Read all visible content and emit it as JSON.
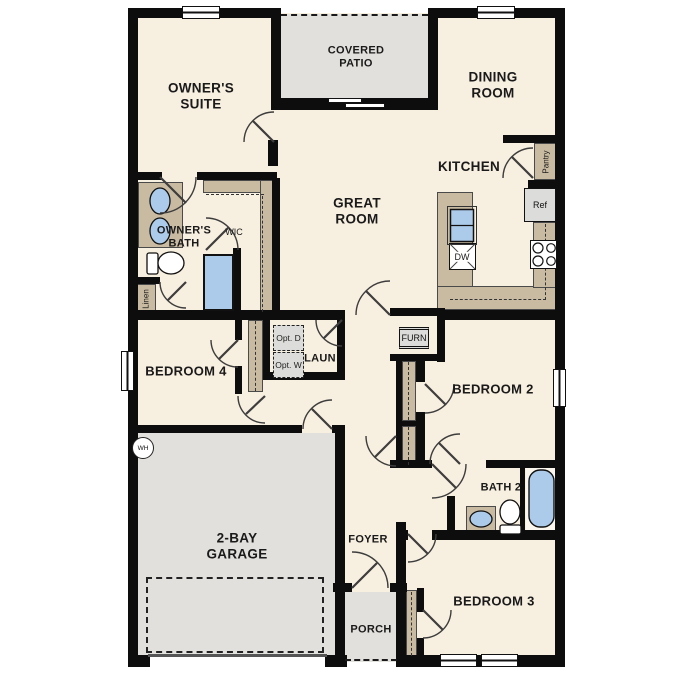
{
  "plan_title": "single-story floor plan",
  "colors": {
    "floor": "#f7efdf",
    "wall": "#0d0d0d",
    "cabinet": "#c9bba2",
    "concrete": "#e2e0dc",
    "fixture_blue": "#accbea"
  },
  "rooms": {
    "owners_suite": "OWNER'S SUITE",
    "covered_patio": "COVERED PATIO",
    "dining_room": "DINING ROOM",
    "kitchen": "KITCHEN",
    "great_room": "GREAT ROOM",
    "owners_bath": "OWNER'S BATH",
    "wic": "WIC",
    "laundry": "LAUN",
    "bedroom_2": "BEDROOM 2",
    "bedroom_3": "BEDROOM 3",
    "bedroom_4": "BEDROOM 4",
    "bath_2": "BATH 2",
    "garage": "2-BAY GARAGE",
    "foyer": "FOYER",
    "porch": "PORCH"
  },
  "fixtures": {
    "pantry": "Pantry",
    "ref": "Ref",
    "dw": "DW",
    "furn": "FURN",
    "linen": "Linen",
    "water_heater": "WH",
    "opt_dryer": "Opt. D",
    "opt_washer": "Opt. W"
  }
}
